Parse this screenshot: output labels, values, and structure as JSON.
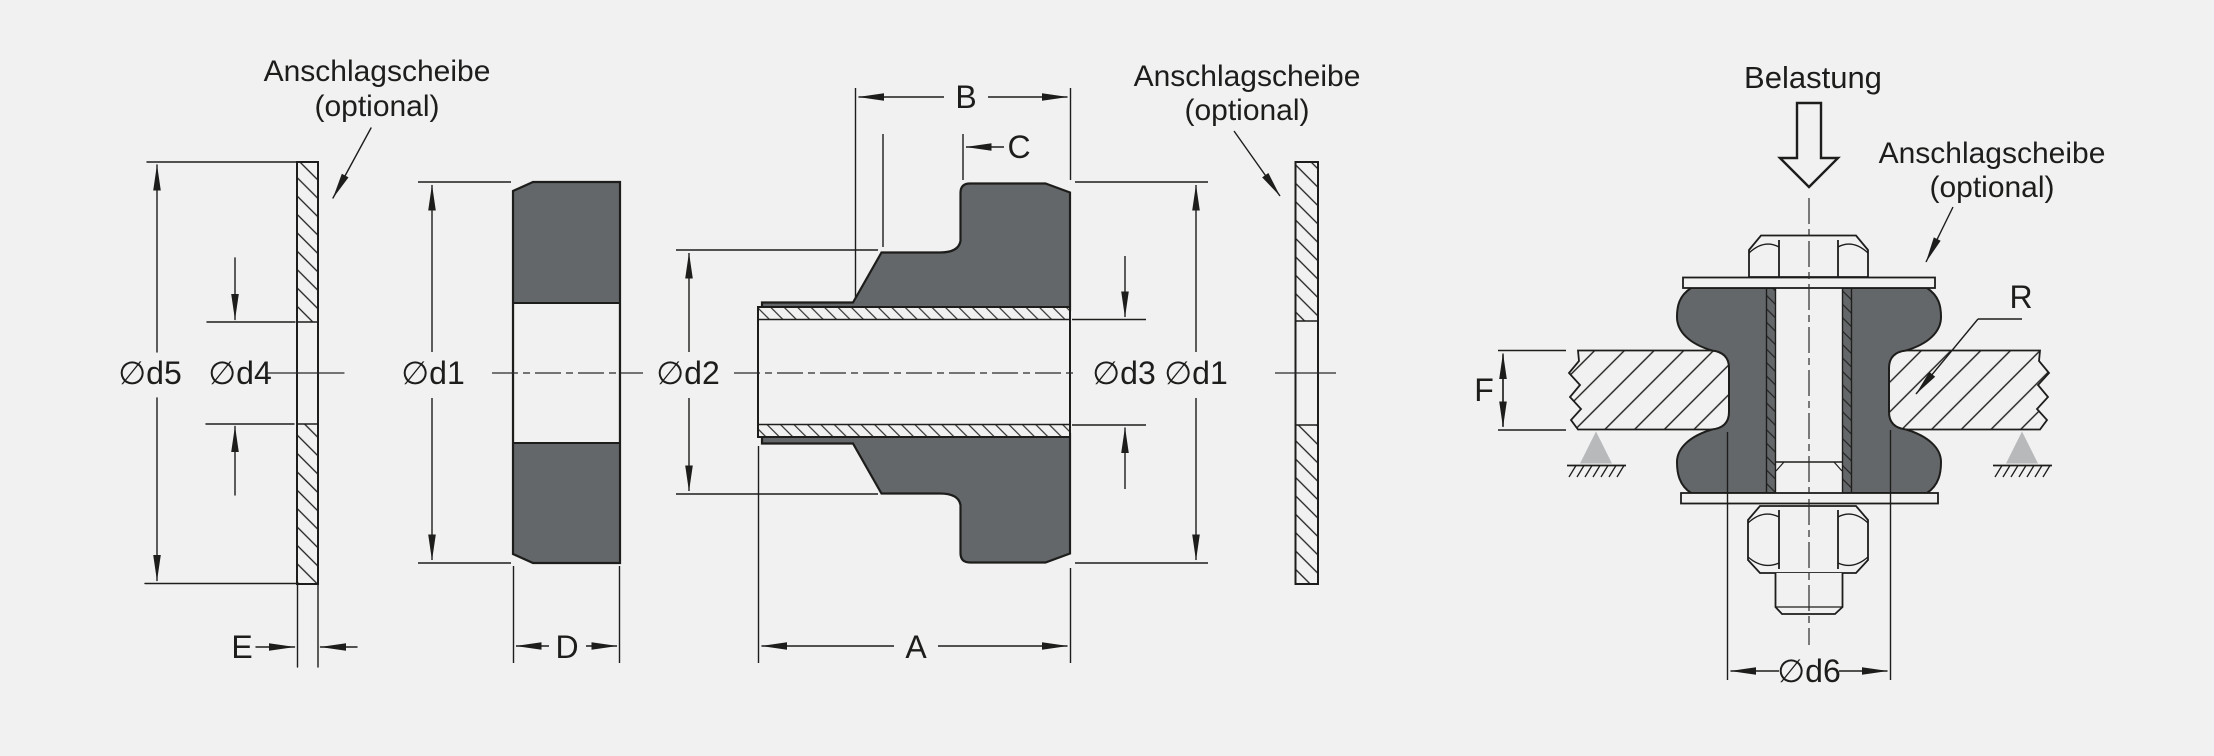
{
  "drawing": {
    "colors": {
      "background": "#f1f1f1",
      "line": "#1d1d1b",
      "rubber_fill": "#64676a",
      "support_fill": "#b7b9ba"
    },
    "annotations": {
      "stop_washer_left": {
        "line1": "Anschlagscheibe",
        "line2": "(optional)"
      },
      "stop_washer_middle": {
        "line1": "Anschlagscheibe",
        "line2": "(optional)"
      },
      "stop_washer_installed": {
        "line1": "Anschlagscheibe",
        "line2": "(optional)"
      },
      "load": "Belastung"
    },
    "dimensions": {
      "d5": "∅d5",
      "d4": "∅d4",
      "e": "E",
      "d1_ring": "∅d1",
      "d_width": "D",
      "d2": "∅d2",
      "b": "B",
      "c": "C",
      "d3": "∅d3",
      "d1_bushing": "∅d1",
      "a": "A",
      "f": "F",
      "r": "R",
      "d6": "∅d6"
    }
  }
}
